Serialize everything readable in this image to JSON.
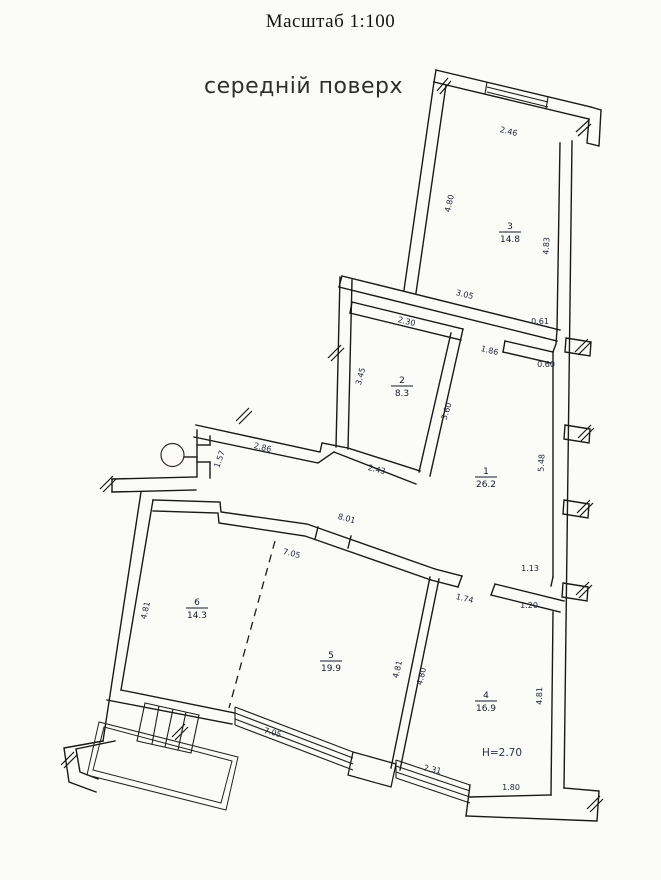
{
  "page": {
    "title": "Масштаб 1:100",
    "subtitle": "середній поверх"
  },
  "floor_plan": {
    "rooms": [
      {
        "number": "3",
        "area": "14.8",
        "x": 510,
        "y": 232
      },
      {
        "number": "2",
        "area": "8.3",
        "x": 402,
        "y": 386
      },
      {
        "number": "1",
        "area": "26.2",
        "x": 486,
        "y": 477
      },
      {
        "number": "6",
        "area": "14.3",
        "x": 197,
        "y": 608
      },
      {
        "number": "5",
        "area": "19.9",
        "x": 331,
        "y": 661
      },
      {
        "number": "4",
        "area": "16.9",
        "x": 486,
        "y": 701
      }
    ],
    "height_note": {
      "text": "H=2.70",
      "x": 502,
      "y": 756
    },
    "dimensions": [
      {
        "text": "2.46",
        "x": 508,
        "y": 134,
        "rot": 14
      },
      {
        "text": "4.80",
        "x": 452,
        "y": 204,
        "rot": -77
      },
      {
        "text": "4.83",
        "x": 549,
        "y": 246,
        "rot": -87
      },
      {
        "text": "3.05",
        "x": 464,
        "y": 297,
        "rot": 14
      },
      {
        "text": "0.61",
        "x": 540,
        "y": 324,
        "rot": 0
      },
      {
        "text": "2.30",
        "x": 406,
        "y": 324,
        "rot": 14
      },
      {
        "text": "1.86",
        "x": 489,
        "y": 353,
        "rot": 14
      },
      {
        "text": "0.60",
        "x": 546,
        "y": 367,
        "rot": 0
      },
      {
        "text": "3.45",
        "x": 363,
        "y": 377,
        "rot": -75
      },
      {
        "text": "3.60",
        "x": 449,
        "y": 412,
        "rot": -72
      },
      {
        "text": "2.43",
        "x": 376,
        "y": 472,
        "rot": 14
      },
      {
        "text": "5.48",
        "x": 544,
        "y": 463,
        "rot": -87
      },
      {
        "text": "1.57",
        "x": 222,
        "y": 460,
        "rot": -70
      },
      {
        "text": "2.86",
        "x": 262,
        "y": 450,
        "rot": 14
      },
      {
        "text": "8.01",
        "x": 346,
        "y": 521,
        "rot": 15
      },
      {
        "text": "7.05",
        "x": 291,
        "y": 556,
        "rot": 15
      },
      {
        "text": "1.13",
        "x": 530,
        "y": 571,
        "rot": 0
      },
      {
        "text": "1.74",
        "x": 464,
        "y": 601,
        "rot": 14
      },
      {
        "text": "1.20",
        "x": 529,
        "y": 608,
        "rot": 0
      },
      {
        "text": "4.81",
        "x": 148,
        "y": 611,
        "rot": -77
      },
      {
        "text": "4.81",
        "x": 400,
        "y": 670,
        "rot": -76
      },
      {
        "text": "4.80",
        "x": 424,
        "y": 677,
        "rot": -76
      },
      {
        "text": "4.81",
        "x": 542,
        "y": 696,
        "rot": -89
      },
      {
        "text": "7.05",
        "x": 272,
        "y": 735,
        "rot": 15
      },
      {
        "text": "2.31",
        "x": 432,
        "y": 772,
        "rot": 12
      },
      {
        "text": "1.80",
        "x": 511,
        "y": 790,
        "rot": 0
      }
    ]
  }
}
